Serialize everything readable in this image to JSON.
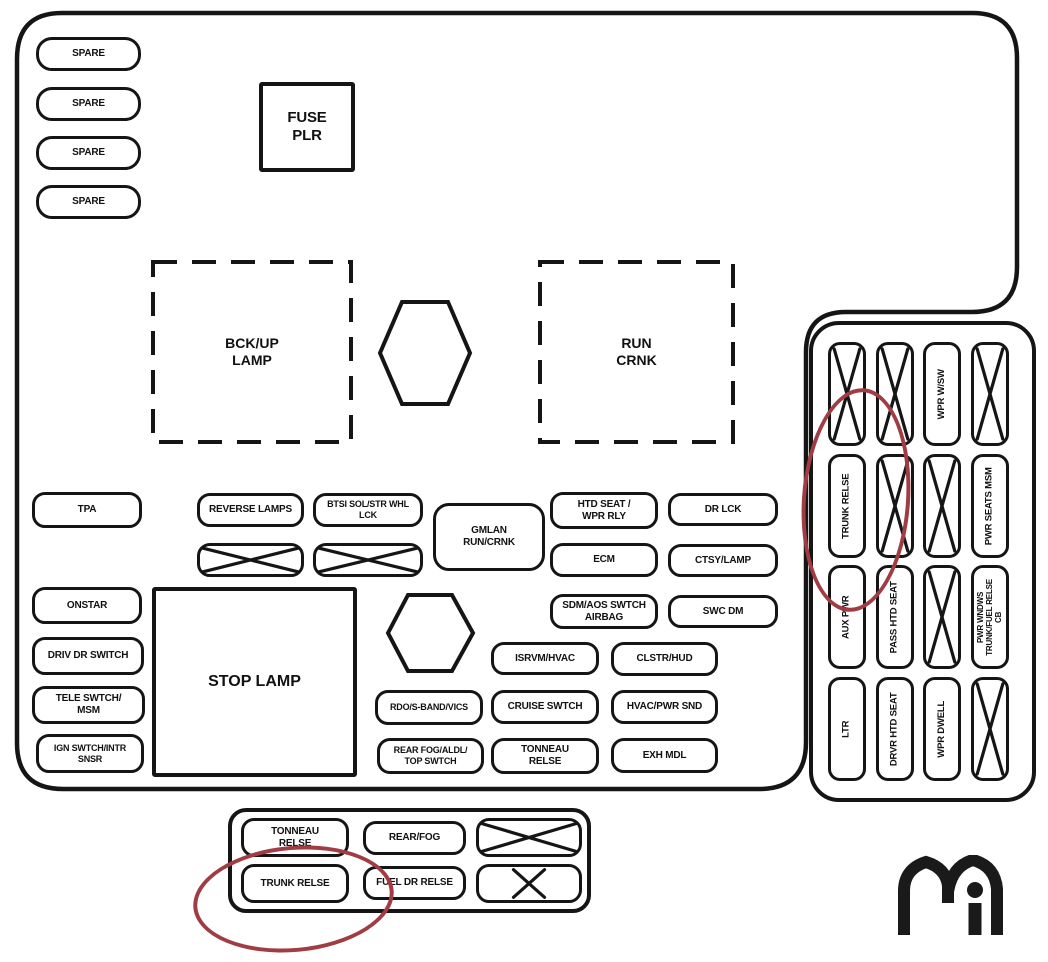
{
  "colors": {
    "line": "#151515",
    "highlight_red": "#a03c44",
    "background": "#ffffff"
  },
  "spares": {
    "s1": "SPARE",
    "s2": "SPARE",
    "s3": "SPARE",
    "s4": "SPARE"
  },
  "center": {
    "fuse_plr": "FUSE\nPLR",
    "bckup_lamp": "BCK/UP\nLAMP",
    "run_crnk": "RUN\nCRNK",
    "gmlan_run_crnk": "GMLAN\nRUN/CRNK",
    "stop_lamp": "STOP LAMP"
  },
  "left_column": {
    "tpa": "TPA",
    "onstar": "ONSTAR",
    "driv_dr_switch": "DRIV DR SWITCH",
    "tele_swtch_msm": "TELE SWTCH/\nMSM",
    "ign_swtch_intr_snsr": "IGN SWTCH/INTR SNSR"
  },
  "mid_grid": {
    "reverse_lamps": "REVERSE LAMPS",
    "btsi_sol_str_whl_lck": "BTSI SOL/STR WHL LCK",
    "htd_seat_wpr_rly": "HTD SEAT /\nWPR RLY",
    "ecm": "ECM",
    "sdm_aos_swtch_airbag": "SDM/AOS SWTCH\nAIRBAG",
    "dr_lck": "DR LCK",
    "ctsy_lamp": "CTSY/LAMP",
    "swc_dm": "SWC DM",
    "isrvm_hvac": "ISRVM/HVAC",
    "clstr_hud": "CLSTR/HUD",
    "rdo_s_band_vics": "RDO/S-BAND/VICS",
    "cruise_swtch": "CRUISE SWTCH",
    "hvac_pwr_snd": "HVAC/PWR SND",
    "rear_fog_aldl_top_swtch": "REAR FOG/ALDL/\nTOP SWTCH",
    "tonneau_relse": "TONNEAU\nRELSE",
    "exh_mdl": "EXH MDL"
  },
  "side_panel": {
    "wpr_wsw": "WPR W/SW",
    "trunk_relse": "TRUNK RELSE",
    "pwr_seats_msm": "PWR SEATS MSM",
    "aux_pwr": "AUX PWR",
    "pass_htd_seat": "PASS HTD SEAT",
    "pwr_wndws_trunk_fuel_relse_cb": "PWR WNDWS\nTRUNK/FUEL RELSE\nCB",
    "ltr": "LTR",
    "drvr_htd_seat": "DRVR HTD SEAT",
    "wpr_dwell": "WPR DWELL"
  },
  "bottom_panel": {
    "tonneau_relse": "TONNEAU\nRELSE",
    "rear_fog": "REAR/FOG",
    "trunk_relse": "TRUNK RELSE",
    "fuel_dr_relse": "FUEL DR RELSE"
  }
}
